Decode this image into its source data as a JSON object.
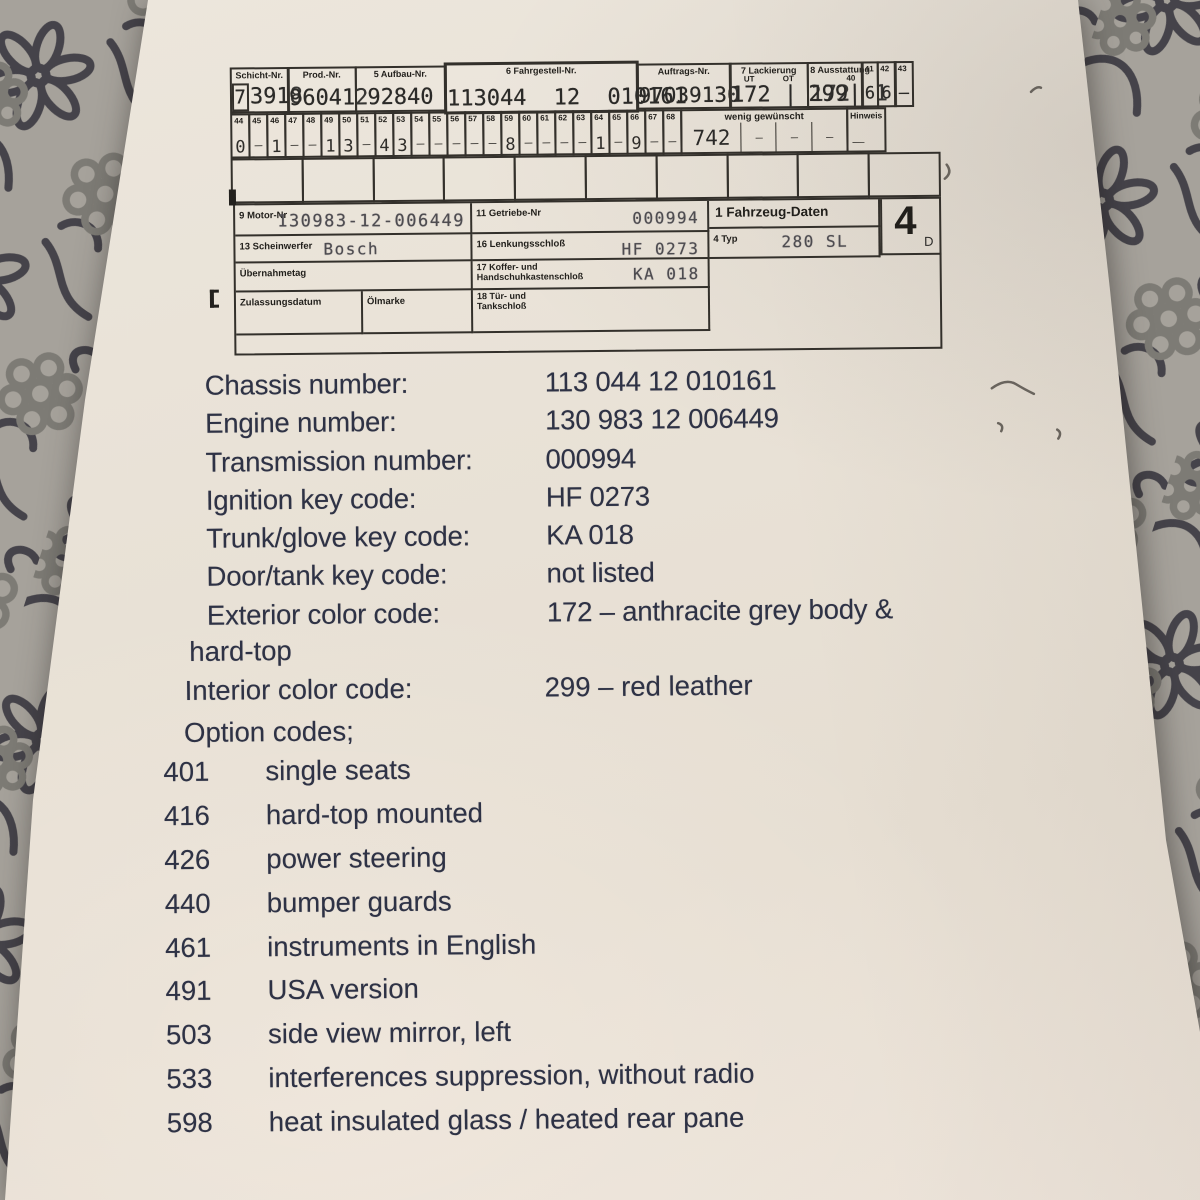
{
  "background": {
    "fabric_base": "#a6a29b",
    "flower_dark": "#45434a",
    "flower_grey": "#7d7b75"
  },
  "paper": {
    "color": "#e9e2d7",
    "ink_color": "#2e3245"
  },
  "card": {
    "top_row": [
      {
        "label": "Schicht-Nr.",
        "prefix": "7",
        "value": "3918"
      },
      {
        "label": "Prod.-Nr.",
        "value": "960412"
      },
      {
        "label": "5 Aufbau-Nr.",
        "value": "92840"
      },
      {
        "label": "6 Fahrgestell-Nr.",
        "value": "113044 12 010161"
      },
      {
        "label": "Auftrags-Nr.",
        "value": "97039130"
      },
      {
        "label": "7 Lackierung",
        "sub": "UT OT",
        "value": "172 | 172"
      },
      {
        "label": "8 Ausstattung",
        "sub": "40",
        "value": "299| 1"
      },
      {
        "label": "41",
        "value": "6"
      },
      {
        "label": "42",
        "value": "6"
      },
      {
        "label": "43",
        "value": "–"
      }
    ],
    "small_cells": [
      {
        "n": "44",
        "v": "0"
      },
      {
        "n": "45",
        "v": "–"
      },
      {
        "n": "46",
        "v": "1"
      },
      {
        "n": "47",
        "v": "–"
      },
      {
        "n": "48",
        "v": "–"
      },
      {
        "n": "49",
        "v": "1"
      },
      {
        "n": "50",
        "v": "3"
      },
      {
        "n": "51",
        "v": "–"
      },
      {
        "n": "52",
        "v": "4"
      },
      {
        "n": "53",
        "v": "3"
      },
      {
        "n": "54",
        "v": "–"
      },
      {
        "n": "55",
        "v": "–"
      },
      {
        "n": "56",
        "v": "–"
      },
      {
        "n": "57",
        "v": "–"
      },
      {
        "n": "58",
        "v": "–"
      },
      {
        "n": "59",
        "v": "8"
      },
      {
        "n": "60",
        "v": "–"
      },
      {
        "n": "61",
        "v": "–"
      },
      {
        "n": "62",
        "v": "–"
      },
      {
        "n": "63",
        "v": "–"
      },
      {
        "n": "64",
        "v": "1"
      },
      {
        "n": "65",
        "v": "–"
      },
      {
        "n": "66",
        "v": "9"
      },
      {
        "n": "67",
        "v": "–"
      },
      {
        "n": "68",
        "v": "–"
      }
    ],
    "wenig": {
      "label": "wenig gewünscht",
      "value": "742",
      "blanks": [
        "—",
        "—",
        "—"
      ]
    },
    "hinweis": {
      "label": "Hinweis",
      "value": "—"
    },
    "motor": {
      "label": "9 Motor-Nr",
      "value": "130983-12-006449"
    },
    "getriebe": {
      "label": "11 Getriebe-Nr",
      "value": "000994"
    },
    "fahrzeug_daten": {
      "label": "1 Fahrzeug-Daten"
    },
    "big_box": {
      "value": "4",
      "sub": "D"
    },
    "scheinwerfer": {
      "label": "13 Scheinwerfer",
      "value": "Bosch"
    },
    "lenkung": {
      "label": "16 Lenkungsschloß",
      "value": "HF 0273"
    },
    "typ": {
      "label": "4 Typ",
      "value": "280 SL"
    },
    "uebernahmetag": {
      "label": "Übernahmetag"
    },
    "koffer": {
      "label_line1": "17 Koffer- und",
      "label_line2": "Handschuhkastenschloß",
      "value": "KA 018"
    },
    "zulassung": {
      "label": "Zulassungsdatum"
    },
    "oelmarke": {
      "label": "Ölmarke"
    },
    "tuer": {
      "label_line1": "18 Tür- und",
      "label_line2": "Tankschloß"
    }
  },
  "details": {
    "rows": [
      {
        "label": "Chassis number:",
        "value": "113 044 12 010161"
      },
      {
        "label": "Engine number:",
        "value": "130 983 12 006449"
      },
      {
        "label": "Transmission number:",
        "value": "000994"
      },
      {
        "label": "Ignition key code:",
        "value": "HF 0273"
      },
      {
        "label": "Trunk/glove key code:",
        "value": "KA 018"
      },
      {
        "label": "Door/tank key code:",
        "value": "not listed"
      },
      {
        "label": "Exterior color code:",
        "value": "172 – anthracite grey body &"
      }
    ],
    "continuation": "hard-top",
    "interior": {
      "label": "Interior color code:",
      "value": "299 – red leather"
    },
    "options_heading": "Option codes;",
    "options": [
      {
        "code": "401",
        "label": "single seats"
      },
      {
        "code": "416",
        "label": "hard-top mounted"
      },
      {
        "code": "426",
        "label": "power steering"
      },
      {
        "code": "440",
        "label": "bumper guards"
      },
      {
        "code": "461",
        "label": "instruments in English"
      },
      {
        "code": "491",
        "label": "USA version"
      },
      {
        "code": "503",
        "label": "side view mirror, left"
      },
      {
        "code": "533",
        "label": "interferences suppression, without radio"
      },
      {
        "code": "598",
        "label": "heat insulated glass / heated rear pane"
      }
    ]
  }
}
